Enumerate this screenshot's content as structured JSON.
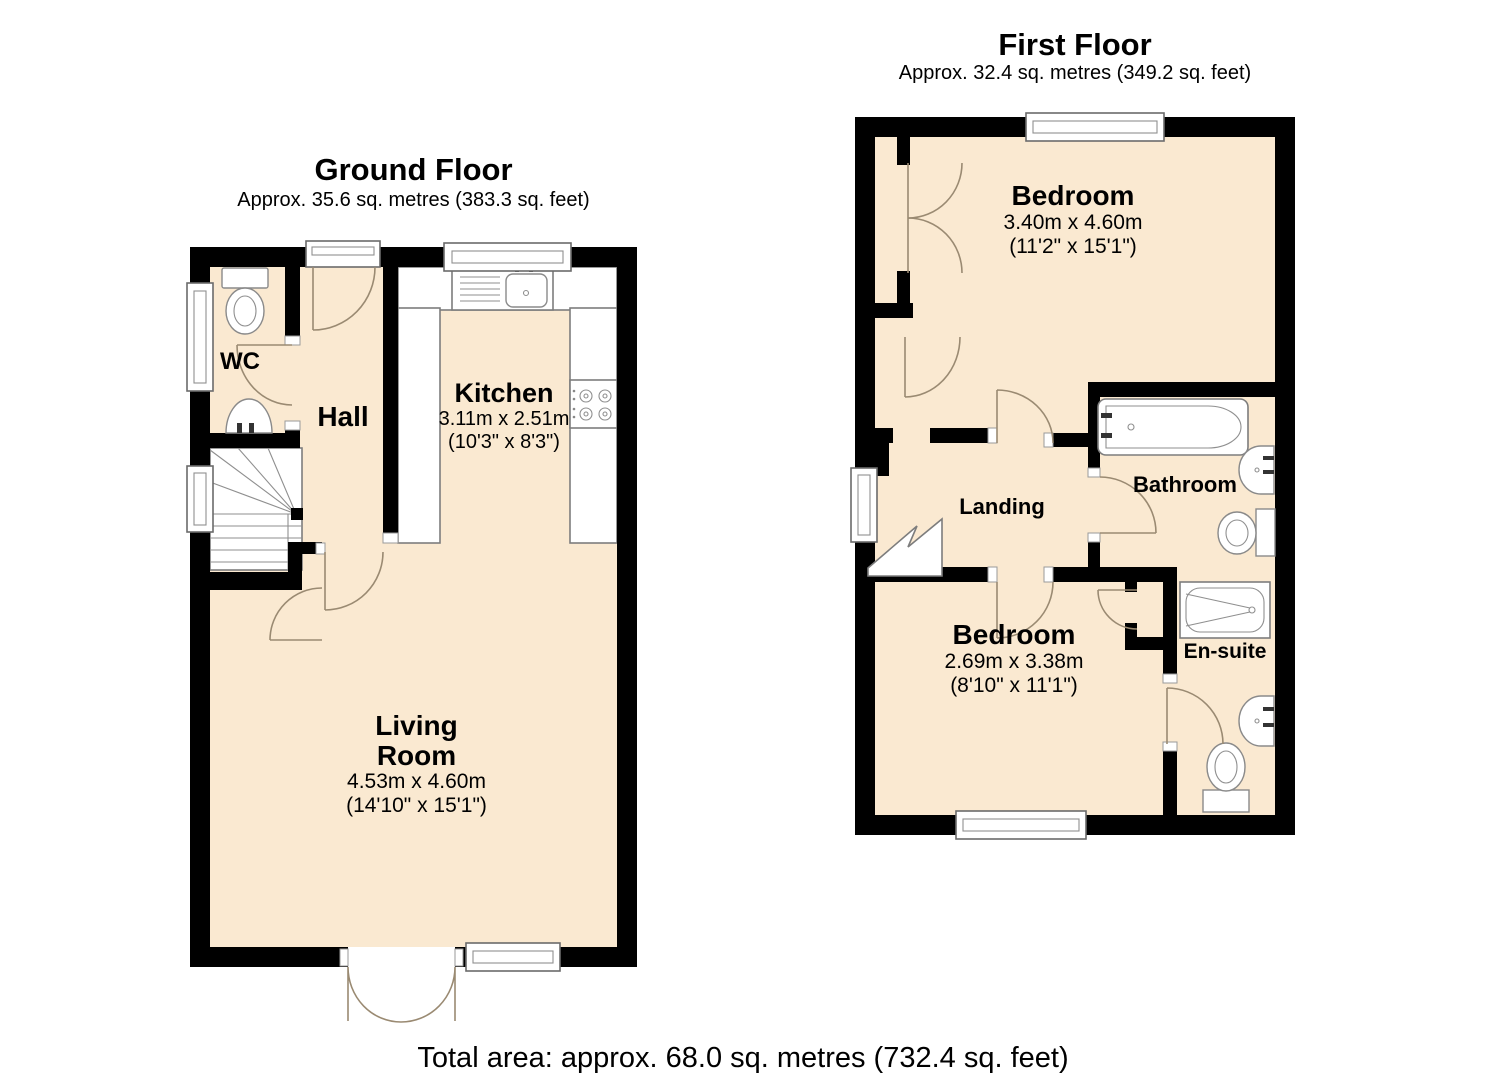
{
  "ground_floor": {
    "title": "Ground Floor",
    "subtitle": "Approx. 35.6 sq. metres (383.3 sq. feet)",
    "rooms": {
      "wc": {
        "name": "WC"
      },
      "hall": {
        "name": "Hall"
      },
      "kitchen": {
        "name": "Kitchen",
        "dims_metric": "3.11m x 2.51m",
        "dims_imperial": "(10'3\" x 8'3\")"
      },
      "living_room": {
        "name_line1": "Living",
        "name_line2": "Room",
        "dims_metric": "4.53m x 4.60m",
        "dims_imperial": "(14'10\" x 15'1\")"
      }
    }
  },
  "first_floor": {
    "title": "First Floor",
    "subtitle": "Approx. 32.4 sq. metres (349.2 sq. feet)",
    "rooms": {
      "bedroom_front": {
        "name": "Bedroom",
        "dims_metric": "3.40m x 4.60m",
        "dims_imperial": "(11'2\" x 15'1\")"
      },
      "bedroom_back": {
        "name": "Bedroom",
        "dims_metric": "2.69m x 3.38m",
        "dims_imperial": "(8'10\" x 11'1\")"
      },
      "bathroom": {
        "name": "Bathroom"
      },
      "en_suite": {
        "name": "En-suite"
      },
      "landing": {
        "name": "Landing"
      }
    }
  },
  "footer": {
    "total_area": "Total area: approx. 68.0 sq. metres (732.4 sq. feet)"
  },
  "colors": {
    "floor": "#FAE9D1",
    "wall": "#000000",
    "door_arc": "#9A8A72",
    "fixture_outline": "#7D7D7D"
  }
}
